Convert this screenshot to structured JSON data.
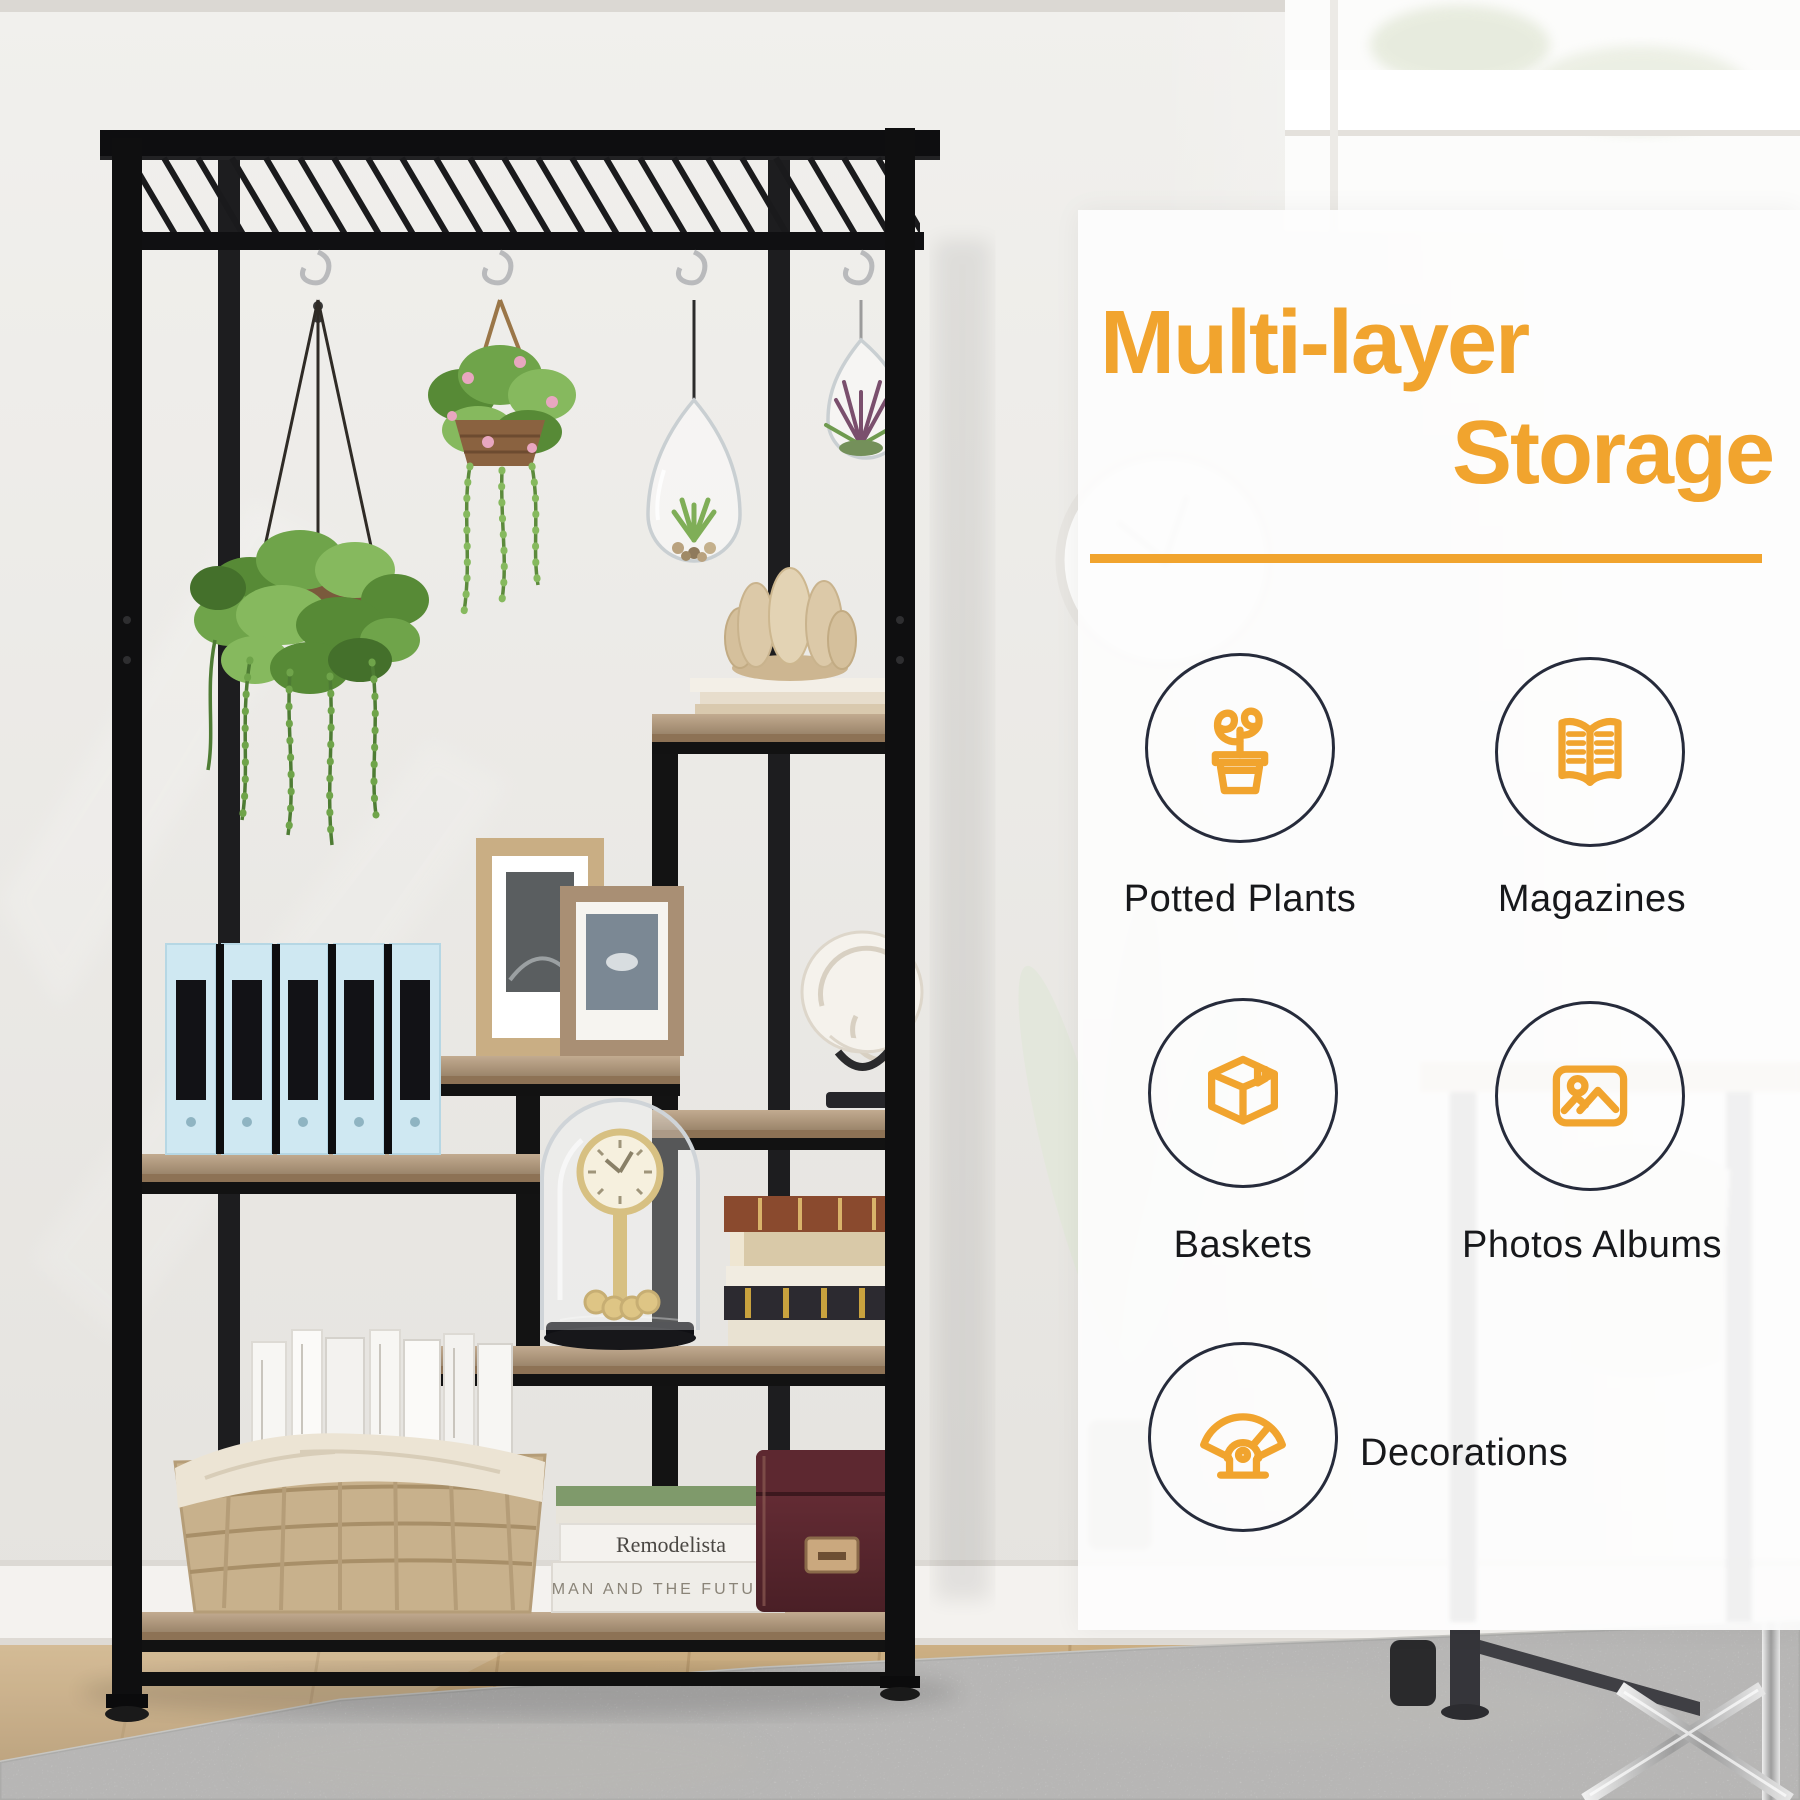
{
  "overlay": {
    "title_line1": "Multi-layer",
    "title_line2": "Storage Design",
    "features": [
      {
        "icon": "potted-plant-icon",
        "label": "Potted Plants"
      },
      {
        "icon": "open-book-icon",
        "label": "Magazines"
      },
      {
        "icon": "storage-box-icon",
        "label": "Baskets"
      },
      {
        "icon": "photo-frame-icon",
        "label": "Photos Albums"
      },
      {
        "icon": "hand-fan-icon",
        "label": "Decorations"
      }
    ]
  },
  "scene": {
    "book_spines": [
      "Remodelista",
      "MAN AND THE FUTURE"
    ]
  },
  "colors": {
    "accent": "#F1A42E",
    "circle-border": "#262B3B",
    "label": "#17181B",
    "panel": "rgba(253,253,253,0.92)"
  }
}
